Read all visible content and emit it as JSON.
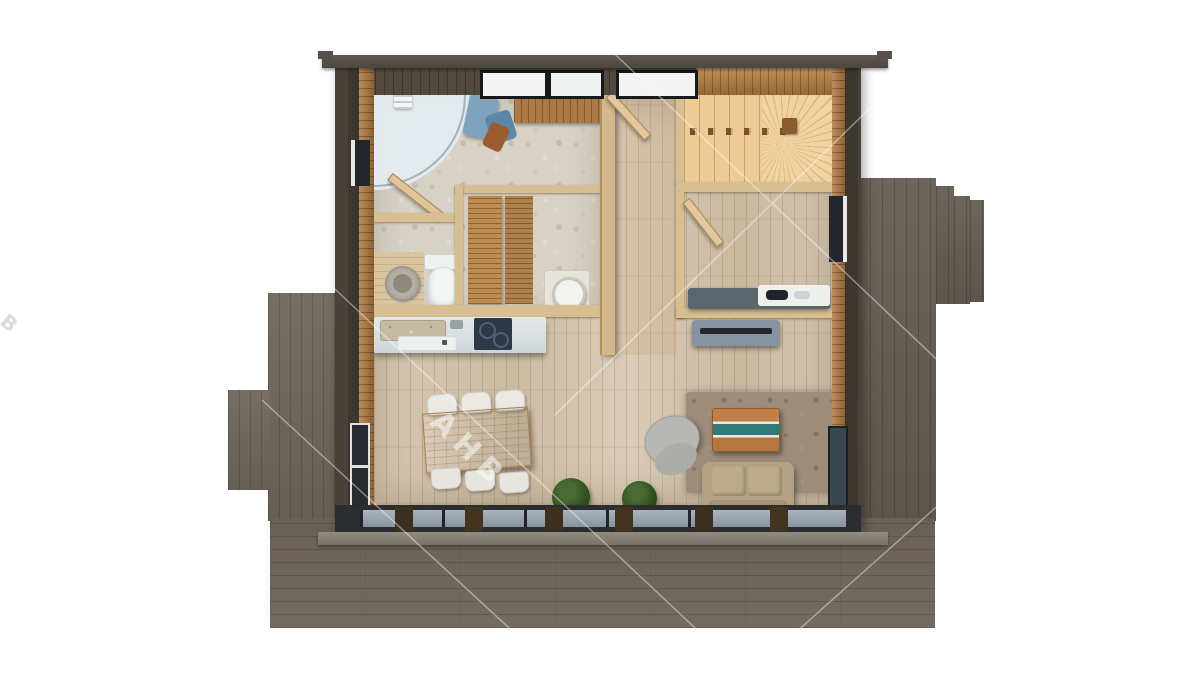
{
  "scene": {
    "description": "Top-down 3D rendered floor plan of a single-storey timber cabin surrounded by dark grey wooden decks on a white background",
    "watermark": {
      "text": "АНВ",
      "edge_text": "АНВ"
    },
    "rooms": [
      {
        "name": "bathroom",
        "features": [
          "corner-shower",
          "toilet",
          "round-washbasin",
          "blue-towels",
          "wood-bench",
          "pebble-floor"
        ]
      },
      {
        "name": "sauna",
        "features": [
          "slatted-bench-1",
          "slatted-bench-2",
          "heater-cylinder"
        ]
      },
      {
        "name": "kitchen",
        "features": [
          "counter",
          "stone-sink",
          "dishwasher-front",
          "induction-cooktop",
          "faucet"
        ]
      },
      {
        "name": "dining-area",
        "features": [
          "wood-table",
          "six-white-chairs",
          "potted-plant"
        ]
      },
      {
        "name": "hallway",
        "features": [
          "entry-door",
          "wood-plank-floor"
        ]
      },
      {
        "name": "staircase",
        "features": [
          "straight-flight",
          "winder-steps",
          "railing-with-posts"
        ]
      },
      {
        "name": "office",
        "features": [
          "desk",
          "open-door",
          "side-window"
        ]
      },
      {
        "name": "living-room",
        "features": [
          "sofa",
          "river-epoxy-coffee-table",
          "rug",
          "grey-pouf",
          "tv-console",
          "potted-plant"
        ]
      }
    ],
    "exterior": [
      "left-deck",
      "right-deck-with-steps",
      "bottom-terrace",
      "roof-fascia",
      "glazed-south-wall"
    ],
    "colors": {
      "background": "#ffffff",
      "deck": "#6f665b",
      "wall_dark": "#4a423a",
      "wood_panel": "#b07a42",
      "interior_floor": "#d4c5b0",
      "pebble_floor": "#d7d1c6",
      "stairs_wood": "#eccb97",
      "sauna_bench": "#bd8c52",
      "dining_table": "#c79a5f",
      "chair_white": "#ebe9e4",
      "sofa_beige": "#b2a283",
      "river_resin": "#2f7a74",
      "tv_console": "#8793a0",
      "cooktop": "#2e3947",
      "glazing": "#9aa5ad"
    }
  }
}
